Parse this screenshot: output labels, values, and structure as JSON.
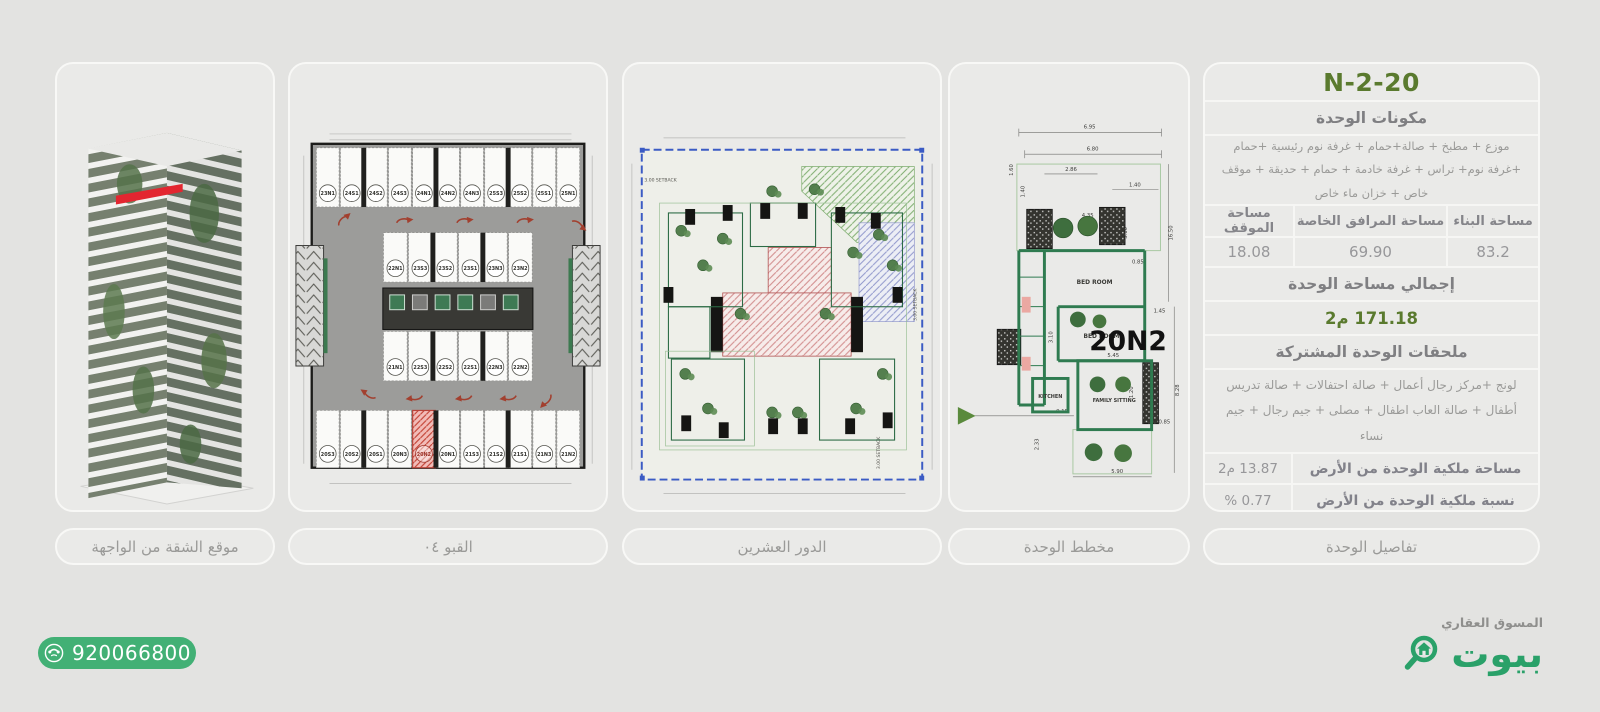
{
  "panels": {
    "tower": {
      "caption": "موقع الشقة من الواجهة"
    },
    "basement": {
      "caption": "القبو ٠٤",
      "stall_rows": {
        "top": [
          "23N1",
          "24S1",
          "24S2",
          "24S3",
          "24N1",
          "24N2",
          "24N3",
          "25S3",
          "25S2",
          "25S1",
          "25N1"
        ],
        "upper_mid": [
          "22N1",
          "23S3",
          "23S2",
          "23S1",
          "23N3",
          "23N2"
        ],
        "lower_mid": [
          "21N1",
          "22S3",
          "22S2",
          "22S1",
          "22N3",
          "22N2"
        ],
        "bottom": [
          "20S3",
          "20S2",
          "20S1",
          "20N3",
          "20N2",
          "20N1",
          "21S3",
          "21S2",
          "21S1",
          "21N3",
          "21N2"
        ]
      },
      "highlighted_stall": "20N2"
    },
    "floor": {
      "caption": "الدور العشرين",
      "setback": "3.00 SETBACK"
    },
    "unit": {
      "caption": "مخطط الوحدة",
      "unit_label": "20N2",
      "rooms": {
        "bedroom1": "BED ROOM",
        "bedroom2": "BED ROOM",
        "kitchen": "KITCHEN",
        "family_sitting": "FAMILY SITTING"
      },
      "dims": [
        "6.95",
        "6.80",
        "2.86",
        "1.40",
        "1.60",
        "1.40",
        "4.35",
        "3.10",
        "0.85",
        "16.50",
        "1.45",
        "3.10",
        "5.45",
        "1.20",
        "9.15",
        "0.85",
        "2.33",
        "5.90",
        "8.28"
      ]
    },
    "details": {
      "caption": "تفاصيل الوحدة",
      "unit_code": "20-N-2",
      "components_title": "مكونات الوحدة",
      "components_text": "موزع + مطبخ + صالة+حمام + غرفة نوم رئيسية +حمام +غرفة نوم+ تراس + غرفة خادمة + حمام + حديقة + موقف خاص + خزان ماء خاص",
      "areas_table": {
        "headers": [
          "مساحة البناء",
          "مساحة المرافق الخاصة",
          "مساحة الموقف"
        ],
        "values": [
          "83.2",
          "69.90",
          "18.08"
        ]
      },
      "total_area_title": "إجمالي مساحة الوحدة",
      "total_area_value": "171.18 م2",
      "shared_title": "ملحقات الوحدة المشتركة",
      "shared_text": "لونج +مركز رجال أعمال + صالة احتفالات + صالة تدريس أطفال + صالة العاب اطفال + مصلى + جيم رجال + جيم نساء",
      "ownership": [
        {
          "label": "مساحة ملكية الوحدة من الأرض",
          "value": "13.87 م2"
        },
        {
          "label": "نسبة ملكية الوحدة من الأرض",
          "value": "0.77 %"
        }
      ]
    }
  },
  "footer": {
    "phone": "920066800",
    "marketer_label": "المسوق العقاري",
    "brand": "بيوت"
  },
  "colors": {
    "page_bg": "#e3e3e1",
    "panel_bg": "#eaeae8",
    "accent_green_dark": "#5a7a2e",
    "brand_green": "#2aa169",
    "phone_green": "#42b075",
    "marker_red": "#e32630",
    "highlight_red": "#c0392b"
  }
}
